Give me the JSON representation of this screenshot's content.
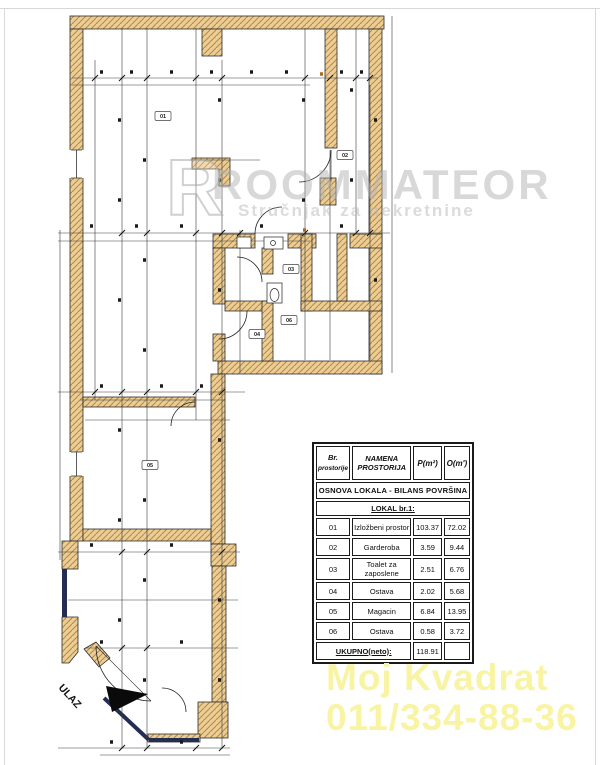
{
  "watermark": {
    "logo_letter": "R",
    "brand": "ROOMMATEOR",
    "tagline": "Stručnjak za nekretnine",
    "color": "#b9b9b9"
  },
  "plan": {
    "entrance_label": "ULAZ",
    "room_labels": [
      {
        "id": "01"
      },
      {
        "id": "02"
      },
      {
        "id": "03"
      },
      {
        "id": "04"
      },
      {
        "id": "05"
      },
      {
        "id": "06"
      }
    ],
    "wall_color": "#eccd96",
    "hatch_line_color": "#b5893f",
    "glass_color": "#242e52"
  },
  "area_table": {
    "header": {
      "col1_line1": "Br.",
      "col1_line2": "prostorije",
      "col2_line1": "NAMENA",
      "col2_line2": "PROSTORIJA",
      "col3": "P(m²)",
      "col4": "O(m')"
    },
    "section_title": "OSNOVA LOKALA  -  BILANS POVRŠINA",
    "group_title": "LOKAL br.1:",
    "rows": [
      {
        "no": "01",
        "name": "Izložbeni prostor",
        "p": "103.37",
        "o": "72.02"
      },
      {
        "no": "02",
        "name": "Garderoba",
        "p": "3.59",
        "o": "9.44"
      },
      {
        "no": "03",
        "name": "Toalet za zaposlene",
        "p": "2.51",
        "o": "6.76"
      },
      {
        "no": "04",
        "name": "Ostava",
        "p": "2.02",
        "o": "5.68"
      },
      {
        "no": "05",
        "name": "Magacin",
        "p": "6.84",
        "o": "13.95"
      },
      {
        "no": "06",
        "name": "Ostava",
        "p": "0.58",
        "o": "3.72"
      }
    ],
    "total_label": "UKUPNO(neto):",
    "total_value": "118.91"
  },
  "contact": {
    "name": "Moj Kvadrat",
    "phone": "011/334-88-36",
    "color": "#f8f4a4"
  }
}
